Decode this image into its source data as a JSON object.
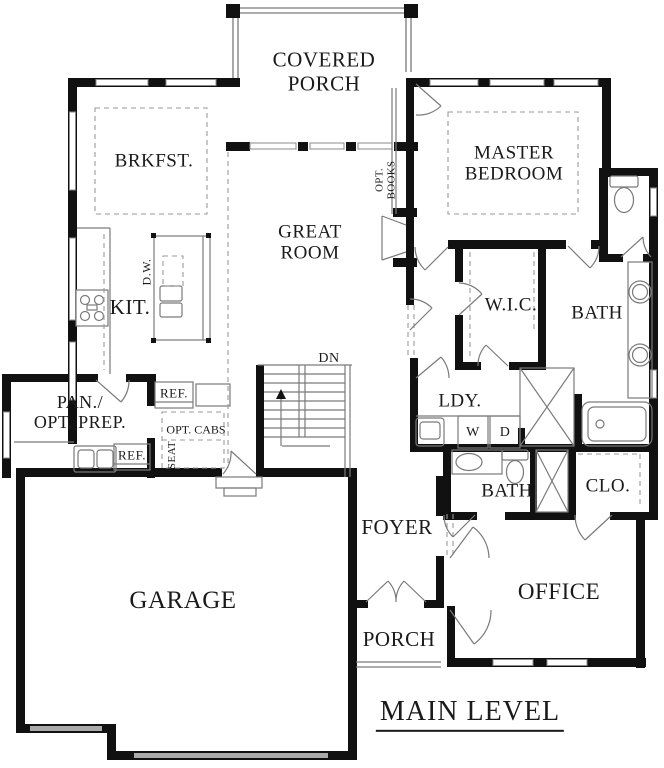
{
  "title": "MAIN LEVEL",
  "rooms": {
    "covered_porch": "COVERED\nPORCH",
    "brkfst": "BRKFST.",
    "master_bedroom": "MASTER\nBEDROOM",
    "great_room": "GREAT\nROOM",
    "opt_books": "OPT.\nBOOKS",
    "kit": "KIT.",
    "dw": "D.W.",
    "wic": "W.I.C.",
    "master_bath": "BATH",
    "pan": "PAN./\nOPT. PREP.",
    "ref_top": "REF.",
    "ref_bottom": "REF.",
    "opt_cabs": "OPT. CABS",
    "seat": "SEAT",
    "dn": "DN",
    "ldy": "LDY.",
    "washer": "W",
    "dryer": "D",
    "bath2": "BATH",
    "clo": "CLO.",
    "foyer": "FOYER",
    "garage": "GARAGE",
    "office": "OFFICE",
    "porch": "PORCH"
  },
  "colors": {
    "wall": "#111111",
    "thin_line": "#7a7a7a",
    "dashed_line": "#9a9a9a",
    "text": "#1a1a1a",
    "window_fill": "#ffffff",
    "garage_door_band": "#aaaaaa"
  }
}
